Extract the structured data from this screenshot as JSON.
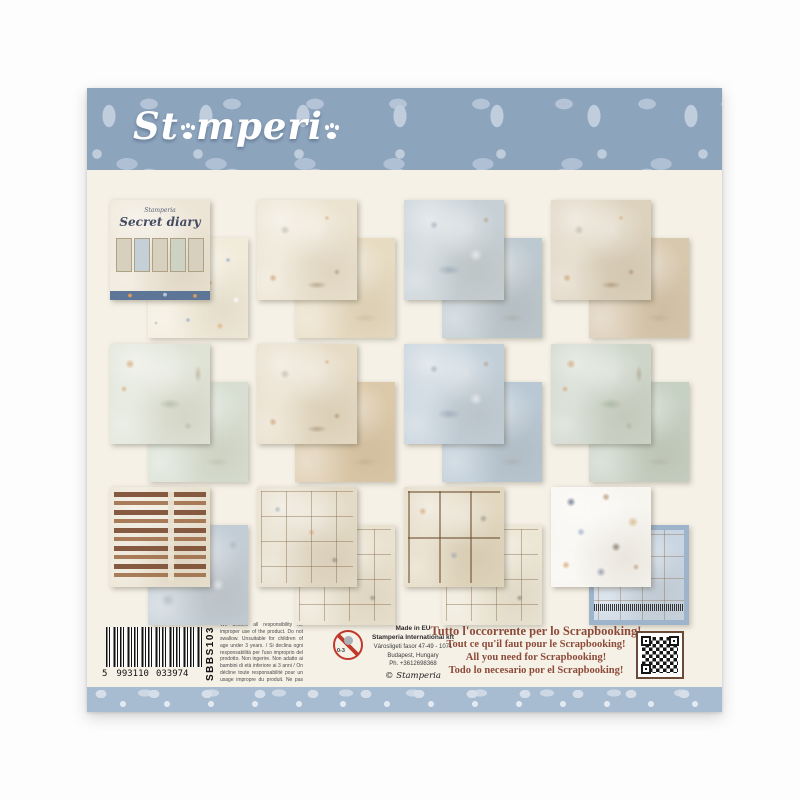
{
  "package": {
    "body_color": "#f5f1e7",
    "top_band_color": "#8da4bd",
    "bottom_band_color": "#a7bcd0"
  },
  "logo": {
    "part1": "St",
    "part2": "mperi",
    "note": "letters a rendered as paw prints"
  },
  "tiles": [
    {
      "desc": "secret-diary-pad-cover-with-flower-pattern-sheet",
      "front_color": "#ece4d4",
      "back_color": "#f1ebda",
      "cover_brand": "Stamperia",
      "cover_title": "Secret diary"
    },
    {
      "desc": "girl-reading-on-ledge-with-book-stacks",
      "front_color": "#ebe2cf",
      "back_color": "#e7dbc1"
    },
    {
      "desc": "blue-grey-collage-with-framed-picture",
      "front_color": "#c6d0d5",
      "back_color": "#bdc9d0"
    },
    {
      "desc": "window-and-cat-journal-collage",
      "front_color": "#ddd2bd",
      "back_color": "#d8c8ae"
    },
    {
      "desc": "sage-texture-with-orange-botanicals-and-labels",
      "front_color": "#dfe3d6",
      "back_color": "#d8dfd2"
    },
    {
      "desc": "cream-collage-with-botanical-sketches",
      "front_color": "#e6dbc5",
      "back_color": "#dcc9a9"
    },
    {
      "desc": "blue-watercolor-with-pocket-watch-notes",
      "front_color": "#c2cfd9",
      "back_color": "#b9c8d4"
    },
    {
      "desc": "sage-paper-with-orange-poppies-and-bird",
      "front_color": "#cdd5c9",
      "back_color": "#c6d0c3"
    },
    {
      "desc": "word-strip-labels-sheet-with-marble-paper",
      "front_color": "#eae2d1",
      "back_color": "#c3cdd6"
    },
    {
      "desc": "tags-frames-and-cards-sheet",
      "front_color": "#e4dbc7",
      "back_color": "#eae2d0"
    },
    {
      "desc": "six-panel-cards-bird-flowers-typewriter-cat",
      "front_color": "#e2d7bf",
      "back_color": "#ece6d5"
    },
    {
      "desc": "die-cut-elements-sheet-with-pack-back-preview",
      "front_color": "#f7f5f0",
      "back_color": "#c9d5e2"
    }
  ],
  "info": {
    "barcode": {
      "digit_lead": "5",
      "group1": "993110",
      "group2": "033974",
      "product_code": "SBBS103"
    },
    "disclaimer": "We decline all responsibility for improper use of the product. Do not swallow. Unsuitable for children of age under 3 years. / Si declina ogni responsabilità per l'uso improprio del prodotto. Non ingerire. Non adatto ai bambini di età inferiore ai 3 anni / On décline toute responsabilité pour un usage impropre du produit. Ne pas ingérer. Ne convient pas aux enfants de moins de 36 mois. / Se declina toda responsabilidad sobre el uso impropio de este producto. No ingerir. No apto para niños menores de 3 años / Wir lehnen jede Verantwortung für unsachgemäßen Gebrauch des Produkts ab. Nicht verschlucken. Nicht geeignet für Kinder unter 3 Jahren.",
    "age_warning": "0-3",
    "made_in": "Made in EU",
    "company": "Stamperia International kft",
    "address_line": "Városligeti fasor 47-49 - 1071",
    "city": "Budapest, Hungary",
    "phone": "Ph. +3612698368",
    "copyright_symbol": "©",
    "signature": "Stamperia",
    "slogans_color": "#8e4a38",
    "slogan_it": "Tutto l'occorrente per lo Scrapbooking!",
    "slogan_fr": "Tout ce qu'il faut pour le Scrapbooking!",
    "slogan_en": "All you need for Scrapbooking!",
    "slogan_es": "Todo lo necesario por el Scrapbooking!"
  }
}
